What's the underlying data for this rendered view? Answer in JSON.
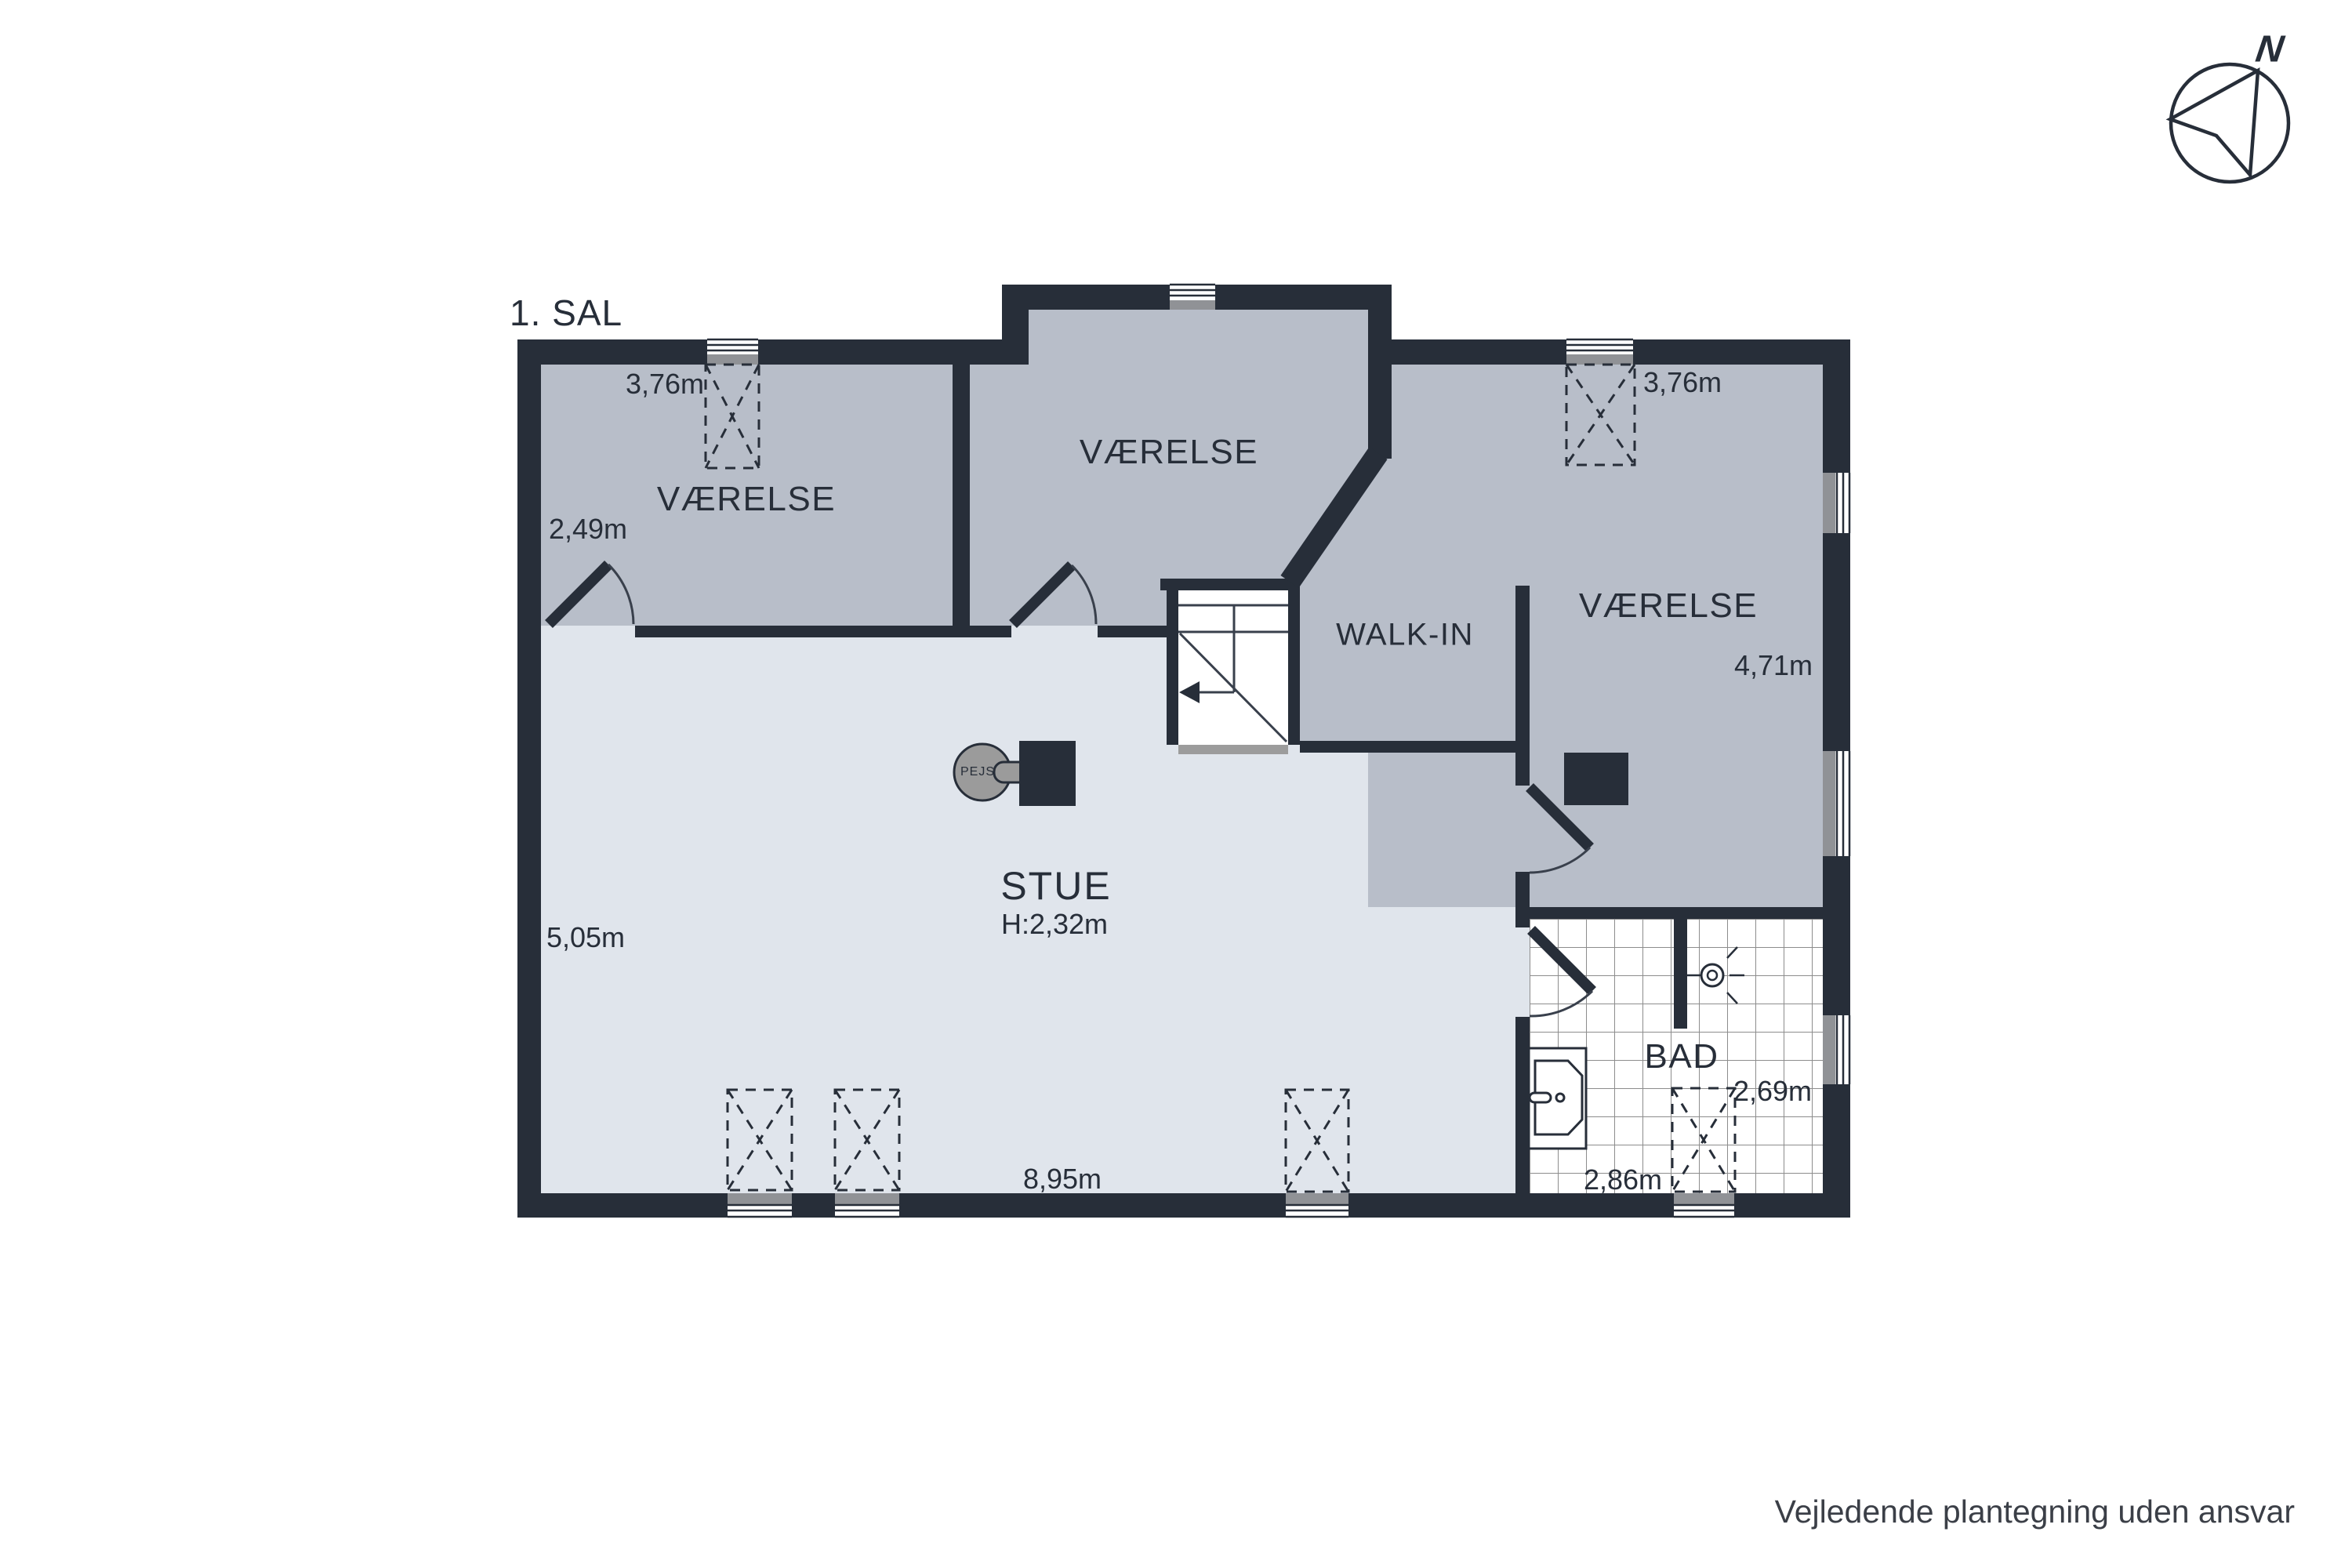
{
  "title": "1. SAL",
  "compass": {
    "north_label": "N"
  },
  "rooms": {
    "vaerelse_top_left": "VÆRELSE",
    "vaerelse_top_middle": "VÆRELSE",
    "vaerelse_right": "VÆRELSE",
    "walk_in": "WALK-IN",
    "stue": "STUE",
    "stue_height": "H:2,32m",
    "bad": "BAD"
  },
  "dimensions": {
    "top_left_width": "3,76m",
    "top_left_depth": "2,49m",
    "top_right_width": "3,76m",
    "right_depth": "4,71m",
    "stue_depth": "5,05m",
    "stue_width": "8,95m",
    "bad_width": "2,86m",
    "bad_depth": "2,69m"
  },
  "fixtures": {
    "fireplace": "PEJS"
  },
  "footer": {
    "disclaimer": "Vejledende plantegning uden ansvar"
  },
  "colors": {
    "wall": "#272e39",
    "room": "#b8bec9",
    "living": "#e0e5ec",
    "sill": "#909296",
    "text": "#272e39",
    "tile_line": "#8d8d8d",
    "fireplace_gray": "#9b9b9b",
    "landing": "#9c9c9c"
  }
}
